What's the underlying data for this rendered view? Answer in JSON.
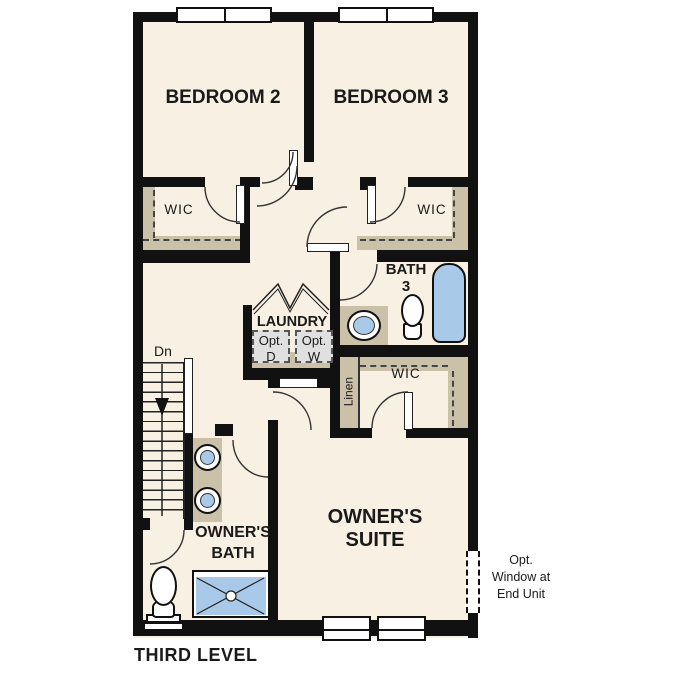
{
  "plan": {
    "title": "THIRD LEVEL",
    "rooms": {
      "bedroom2": "BEDROOM 2",
      "bedroom3": "BEDROOM 3",
      "wic_bedroom2": "WIC",
      "wic_bedroom3": "WIC",
      "wic_owners": "WIC",
      "linen": "Linen",
      "laundry": "LAUNDRY",
      "bath3": [
        "BATH",
        "3"
      ],
      "owners_bath": [
        "OWNER'S",
        "BATH"
      ],
      "owners_suite": [
        "OWNER'S",
        "SUITE"
      ]
    },
    "annotations": {
      "stairs_direction": "Dn",
      "opt_dryer": [
        "Opt.",
        "D"
      ],
      "opt_washer": [
        "Opt.",
        "W"
      ],
      "opt_window": [
        "Opt.",
        "Window at",
        "End Unit"
      ]
    },
    "colors": {
      "wall": "#111111",
      "floor": "#f8f0e2",
      "casework": "#cbc1a9",
      "fixture_blue": "#a9c9e8",
      "appliance_gray": "#e0e0e0"
    }
  }
}
